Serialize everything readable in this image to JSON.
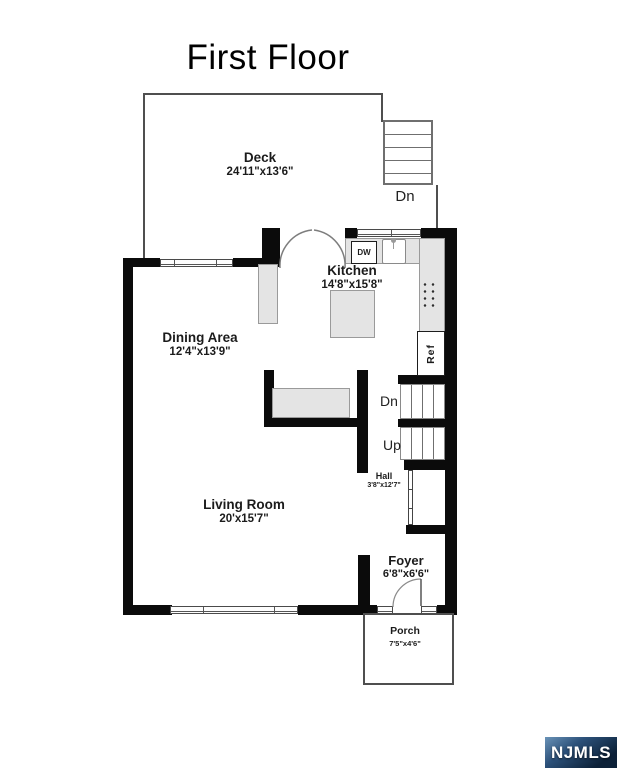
{
  "title": "First Floor",
  "watermark": {
    "label": "NJMLS"
  },
  "rooms": {
    "deck": {
      "name": "Deck",
      "dims": "24'11\"x13'6\""
    },
    "kitchen": {
      "name": "Kitchen",
      "dims": "14'8\"x15'8\""
    },
    "dining": {
      "name": "Dining Area",
      "dims": "12'4\"x13'9\""
    },
    "living": {
      "name": "Living Room",
      "dims": "20'x15'7\""
    },
    "hall": {
      "name": "Hall",
      "dims": "3'8\"x12'7\""
    },
    "foyer": {
      "name": "Foyer",
      "dims": "6'8\"x6'6\""
    },
    "porch": {
      "name": "Porch",
      "dims": "7'5\"x4'6\""
    }
  },
  "labels": {
    "deck_stairs_down": "Dn",
    "basement_stairs_down": "Dn",
    "stairs_up": "Up",
    "dishwasher": "DW",
    "refrigerator": "Ref"
  },
  "colors": {
    "wall": "#0b0b0b",
    "outline_gray": "#4f4f4f",
    "counter_fill": "#e4e4e4",
    "badge_blue_light": "#6a93b8",
    "badge_blue_dark": "#0c2138",
    "text": "#1b1b1b"
  }
}
